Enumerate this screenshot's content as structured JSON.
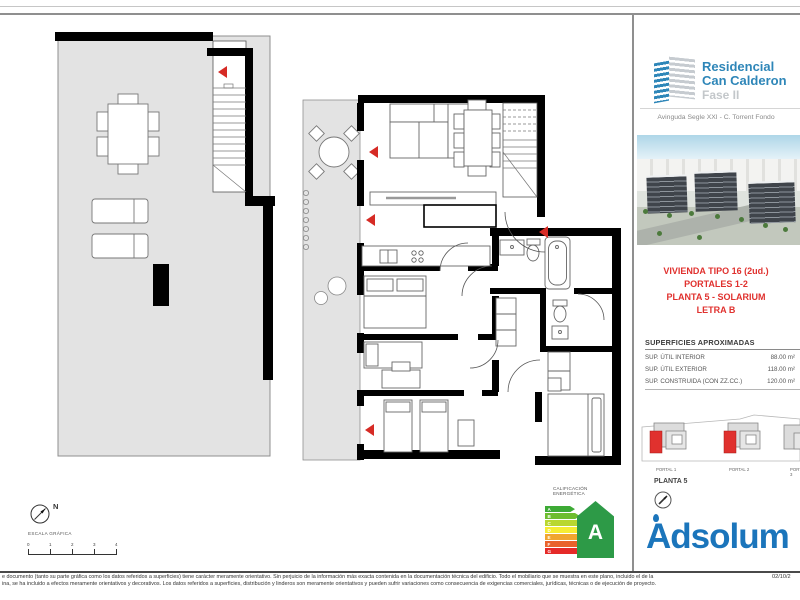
{
  "colors": {
    "brand_blue": "#2e86b8",
    "adsolum_blue": "#1b75bb",
    "accent_red": "#e0312e",
    "plan_floor_gray": "#e3e3e3",
    "energy_arrow_green": "#2d9a47"
  },
  "sidebar": {
    "logo": {
      "icon": "building-logo-icon",
      "name_line1": "Residencial",
      "name_line2": "Can Calderon",
      "phase": "Fase II"
    },
    "address": "Avinguda Segle XXI - C. Torrent Fondo",
    "render_image": "aerial-render-of-residential-complex",
    "unit": {
      "type": "VIVIENDA TIPO 16 (2ud.)",
      "portales": "PORTALES 1-2",
      "planta": "PLANTA 5 - SOLARIUM",
      "letra": "LETRA B"
    },
    "surfaces": {
      "title": "SUPERFICIES APROXIMADAS",
      "rows": [
        {
          "label": "SUP. ÚTIL INTERIOR",
          "value": "88.00 m²"
        },
        {
          "label": "SUP. ÚTIL EXTERIOR",
          "value": "118.00 m²"
        },
        {
          "label": "SUP. CONSTRUIDA (CON ZZ.CC.)",
          "value": "120.00 m²"
        }
      ]
    },
    "site_plan": {
      "portal_labels": [
        "PORTAL 1",
        "PORTAL 2",
        "PORTAL 3"
      ],
      "floor_label": "PLANTA 5",
      "compass_icon": "north-compass-icon",
      "highlight_color": "#e0312e"
    },
    "brand": "Adsolum"
  },
  "plan": {
    "energy": {
      "title_line1": "CALIFICACIÓN",
      "title_line2": "ENERGÉTICA",
      "rating": "A",
      "bars": [
        {
          "letter": "A",
          "color": "#3daa35"
        },
        {
          "letter": "B",
          "color": "#6dbd2e"
        },
        {
          "letter": "C",
          "color": "#b9d730"
        },
        {
          "letter": "D",
          "color": "#f6ec33"
        },
        {
          "letter": "E",
          "color": "#f0a52f"
        },
        {
          "letter": "F",
          "color": "#e9622b"
        },
        {
          "letter": "G",
          "color": "#e52a28"
        }
      ]
    },
    "compass": {
      "label": "N",
      "icon": "north-compass-icon"
    },
    "scale": {
      "title": "ESCALA GRÁFICA",
      "ticks": [
        "0",
        "1",
        "2",
        "3",
        "4"
      ]
    }
  },
  "footer": {
    "disclaimer_line1": "e documento (tanto su parte gráfica como los datos referidos a superficies) tiene carácter meramente orientativo. Sin perjuicio de la información más exacta contenida en la documentación técnica del edificio. Todo el mobiliario que se muestra en este plano, incluido el de la",
    "disclaimer_line2": "ina, se ha incluido a efectos meramente orientativos y decorativos. Los datos referidos a superficies, distribución y linderos son meramente orientativos y pueden sufrir variaciones como consecuencia de exigencias comerciales, jurídicas, técnicas o de ejecución de proyecto.",
    "date": "02/10/2"
  }
}
